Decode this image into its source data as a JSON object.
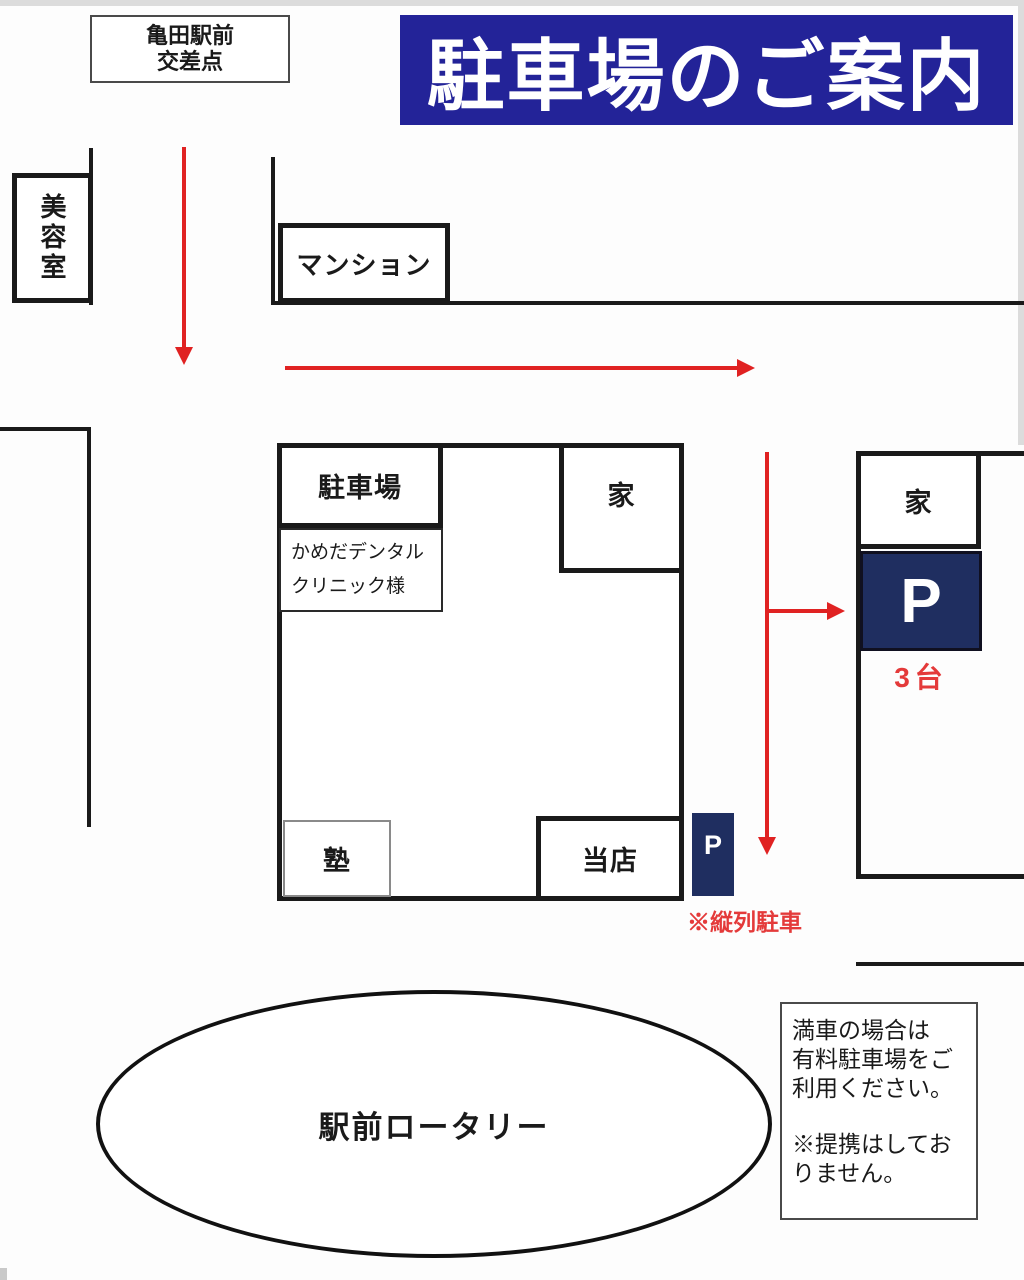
{
  "title_banner": {
    "text": "駐車場のご案内"
  },
  "landmarks": {
    "intersection": {
      "line1": "亀田駅前",
      "line2": "交差点"
    },
    "beauty_salon": "美容室",
    "mansion": "マンション",
    "parking_lot": "駐車場",
    "dental_clinic": {
      "line1": "かめだデンタル",
      "line2": "クリニック様"
    },
    "house_center": "家",
    "house_right": "家",
    "cram_school": "塾",
    "our_store": "当店",
    "rotary": "駅前ロータリー"
  },
  "parking": {
    "p_large": {
      "label": "P",
      "capacity": "3台"
    },
    "p_small": {
      "label": "P",
      "note": "※縦列駐車"
    }
  },
  "notice": {
    "lines": [
      "満車の場合は",
      "有料駐車場をご",
      "利用ください。",
      "※提携はしてお",
      "りません。"
    ]
  },
  "colors": {
    "banner_bg": "#232398",
    "p_navy": "#1f2e60",
    "arrow_red": "#e02222",
    "text_red": "#e43a3a",
    "line_black": "#1a1a1a"
  }
}
